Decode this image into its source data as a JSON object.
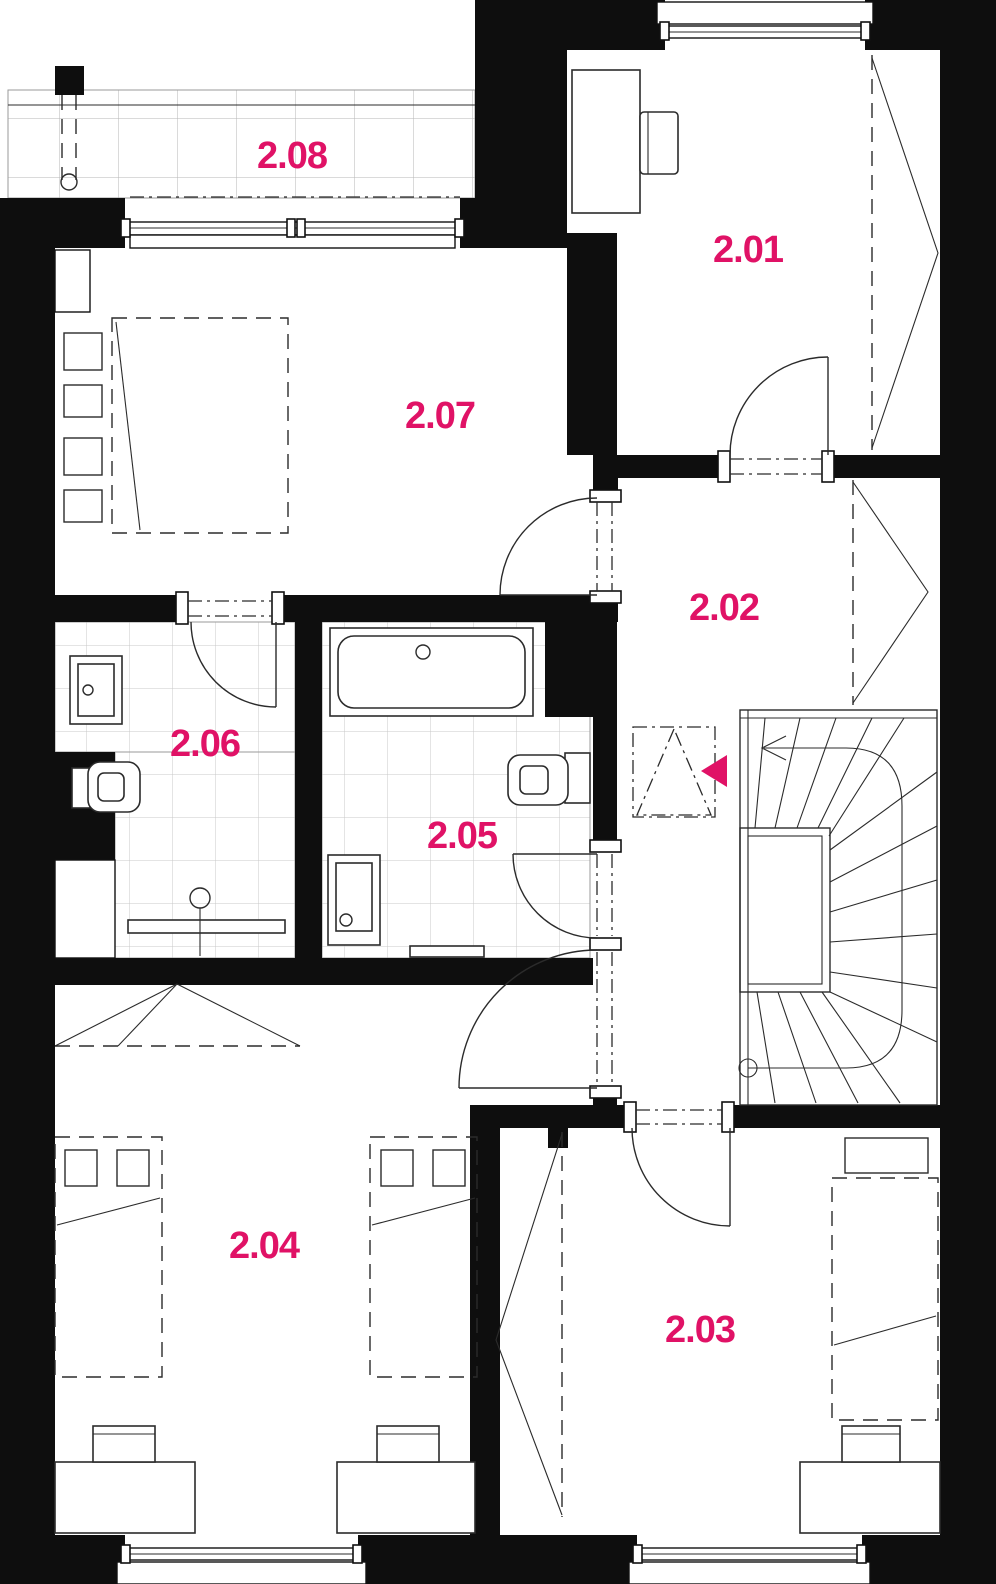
{
  "plan": {
    "colors": {
      "accent": "#e01266",
      "wall": "#0e0e0e",
      "line": "#2b2b2b",
      "tile": "#c9c9c9"
    },
    "rooms": [
      {
        "id": "2.01",
        "label": "2.01"
      },
      {
        "id": "2.02",
        "label": "2.02"
      },
      {
        "id": "2.03",
        "label": "2.03"
      },
      {
        "id": "2.04",
        "label": "2.04"
      },
      {
        "id": "2.05",
        "label": "2.05"
      },
      {
        "id": "2.06",
        "label": "2.06"
      },
      {
        "id": "2.07",
        "label": "2.07"
      },
      {
        "id": "2.08",
        "label": "2.08"
      }
    ],
    "markers": {
      "entry_arrow": "filled-triangle-left",
      "stair_direction_arrow": "arrow-left"
    }
  }
}
